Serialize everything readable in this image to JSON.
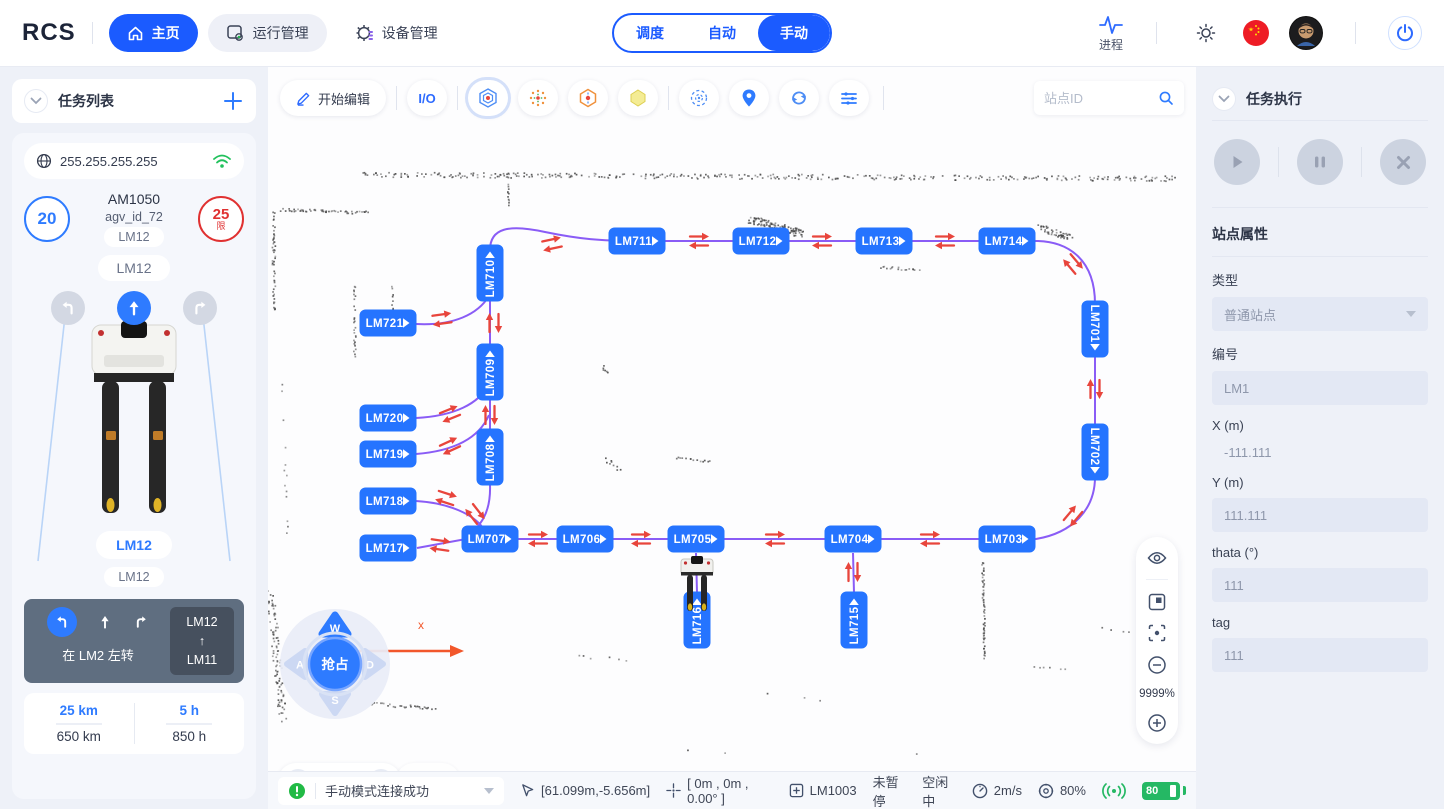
{
  "app": {
    "logo": "RCS"
  },
  "topbar": {
    "nav": [
      {
        "label": "主页"
      },
      {
        "label": "运行管理"
      },
      {
        "label": "设备管理"
      }
    ],
    "modes": [
      {
        "label": "调度"
      },
      {
        "label": "自动"
      },
      {
        "label": "手动"
      }
    ],
    "process": "进程"
  },
  "left": {
    "title": "任务列表",
    "ip": "255.255.255.255",
    "speed": "20",
    "model": "AM1050",
    "agv_id": "agv_id_72",
    "limit": "25",
    "limit_tag": "限",
    "pill1": "LM12",
    "pill2": "LM12",
    "pill3": "LM12",
    "pill4": "LM12",
    "hint": {
      "text": "在 LM2 左转",
      "from": "LM12",
      "arrow": "↑",
      "to": "LM11"
    },
    "stats": [
      {
        "v": "25 km",
        "t": "650 km"
      },
      {
        "v": "5 h",
        "t": "850 h"
      }
    ]
  },
  "map": {
    "edit": "开始编辑",
    "io": "I/O",
    "search_placeholder": "站点ID",
    "zoom": "9999%",
    "axis": "x",
    "speed": "0.5m/s",
    "joystick": {
      "w": "W",
      "a": "A",
      "s": "S",
      "d": "D",
      "center": "抢占"
    },
    "stations": [
      {
        "label": "LM710",
        "x": 222,
        "y": 206,
        "o": "vu"
      },
      {
        "label": "LM711",
        "x": 369,
        "y": 174,
        "o": "h"
      },
      {
        "label": "LM712",
        "x": 493,
        "y": 174,
        "o": "h"
      },
      {
        "label": "LM713",
        "x": 616,
        "y": 174,
        "o": "h"
      },
      {
        "label": "LM714",
        "x": 739,
        "y": 174,
        "o": "h"
      },
      {
        "label": "LM721",
        "x": 120,
        "y": 256,
        "o": "h"
      },
      {
        "label": "LM709",
        "x": 222,
        "y": 305,
        "o": "vu"
      },
      {
        "label": "LM720",
        "x": 120,
        "y": 351,
        "o": "h"
      },
      {
        "label": "LM719",
        "x": 120,
        "y": 387,
        "o": "h"
      },
      {
        "label": "LM708",
        "x": 222,
        "y": 390,
        "o": "vu"
      },
      {
        "label": "LM718",
        "x": 120,
        "y": 434,
        "o": "h"
      },
      {
        "label": "LM717",
        "x": 120,
        "y": 481,
        "o": "h"
      },
      {
        "label": "LM707",
        "x": 222,
        "y": 472,
        "o": "h"
      },
      {
        "label": "LM706",
        "x": 317,
        "y": 472,
        "o": "h"
      },
      {
        "label": "LM705",
        "x": 428,
        "y": 472,
        "o": "h"
      },
      {
        "label": "LM704",
        "x": 585,
        "y": 472,
        "o": "h"
      },
      {
        "label": "LM703",
        "x": 739,
        "y": 472,
        "o": "h"
      },
      {
        "label": "LM701",
        "x": 827,
        "y": 262,
        "o": "vd"
      },
      {
        "label": "LM702",
        "x": 827,
        "y": 385,
        "o": "vd"
      },
      {
        "label": "LM716",
        "x": 429,
        "y": 553,
        "o": "vu"
      },
      {
        "label": "LM715",
        "x": 586,
        "y": 553,
        "o": "vu"
      }
    ]
  },
  "right": {
    "title": "任务执行",
    "props_title": "站点属性",
    "f_type": {
      "label": "类型",
      "value": "普通站点"
    },
    "f_code": {
      "label": "编号",
      "value": "LM1"
    },
    "f_x": {
      "label": "X (m)",
      "value": "-111.111"
    },
    "f_y": {
      "label": "Y (m)",
      "value": "111.111"
    },
    "f_theta": {
      "label": "thata (°)",
      "value": "111"
    },
    "f_tag": {
      "label": "tag",
      "value": "111"
    }
  },
  "status": {
    "message": "手动模式连接成功",
    "cursor": "[61.099m,-5.656m]",
    "pose": "[ 0m , 0m , 0.00° ]",
    "station": "LM1003",
    "pause": "未暂停",
    "idle": "空闲中",
    "speed": "2m/s",
    "confidence": "80%",
    "battery": "80"
  },
  "colors": {
    "accent": "#1b5bff",
    "station_blue": "#2574ff",
    "path_purple": "#8a5cf6",
    "arrow_red": "#e8453c",
    "ok_green": "#25b864"
  }
}
